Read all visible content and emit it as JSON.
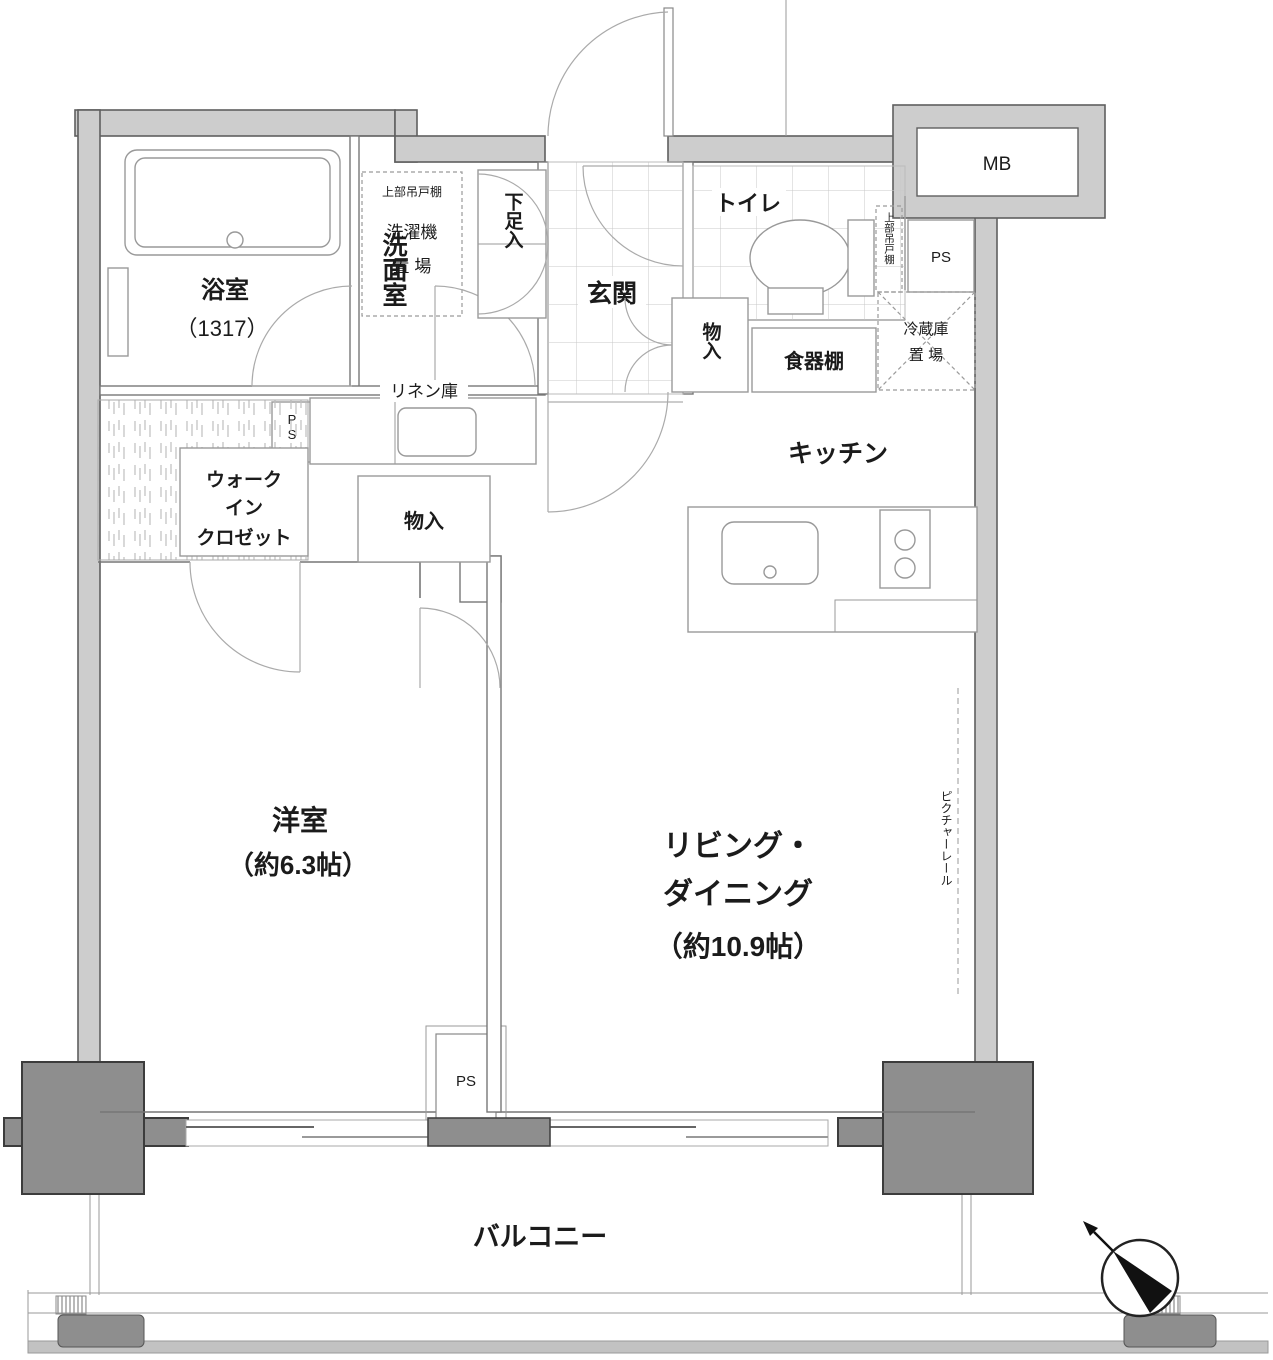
{
  "plan": {
    "type": "floorplan",
    "rooms": {
      "bathroom": {
        "name": "浴室",
        "size": "（1317）"
      },
      "washroom": {
        "name": "洗面室"
      },
      "laundry": {
        "shelf": "上部吊戸棚",
        "line1": "洗濯機",
        "line2": "置 場"
      },
      "shoe_cabinet": {
        "name": "下足入"
      },
      "entrance": {
        "name": "玄関"
      },
      "toilet": {
        "name": "トイレ",
        "shelf": "上部吊戸棚"
      },
      "hall_closet": {
        "name": "物入"
      },
      "cupboard": {
        "name": "食器棚"
      },
      "fridge": {
        "line1": "冷蔵庫",
        "line2": "置 場"
      },
      "kitchen": {
        "name": "キッチン"
      },
      "linen": {
        "name": "リネン庫"
      },
      "walk_in_closet": {
        "line1": "ウォーク",
        "line2": "イン",
        "line3": "クロゼット"
      },
      "center_closet": {
        "name": "物入"
      },
      "western_room": {
        "name": "洋室",
        "size": "（約6.3帖）"
      },
      "living_dining": {
        "line1": "リビング・",
        "line2": "ダイニング",
        "line3": "（約10.9帖）"
      },
      "balcony": {
        "name": "バルコニー"
      }
    },
    "labels": {
      "mb": "MB",
      "ps": "PS",
      "picture_rail": "ピクチャーレール"
    },
    "colors": {
      "wall_fill": "#cdcdcd",
      "wall_edge": "#5f5f5f",
      "pillar_fill": "#8e8e8e",
      "pillar_edge": "#3c3c3c",
      "line": "#777777",
      "grid": "#c6c6c6",
      "text": "#1b1b1b"
    }
  }
}
